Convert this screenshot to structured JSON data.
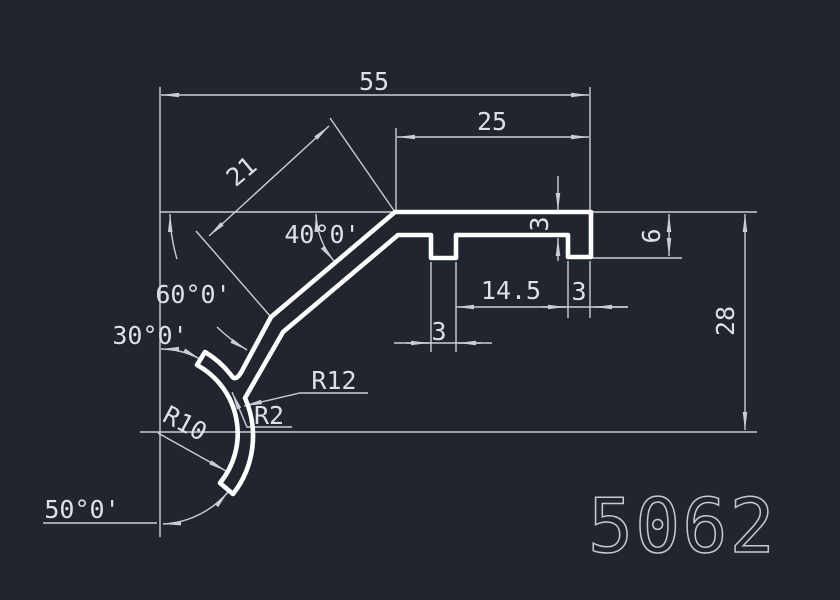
{
  "part_number": "5062",
  "colors": {
    "background": "#20252e",
    "profile_line": "#ffffff",
    "dimension_line": "#c9ced6",
    "dimension_text": "#dde1e6"
  },
  "dimensions": {
    "total_width": "55",
    "top_right_width": "25",
    "slope_length": "21",
    "top_angle": "40°0'",
    "mid_angle": "60°0'",
    "hook_angle": "30°0'",
    "bottom_angle": "50°0'",
    "outer_radius": "R12",
    "fillet_radius": "R2",
    "inner_radius": "R10",
    "groove_spacing": "14.5",
    "leg_width": "3",
    "rib_width": "3",
    "flange_thickness": "3",
    "leg_height": "6",
    "total_height": "28"
  }
}
